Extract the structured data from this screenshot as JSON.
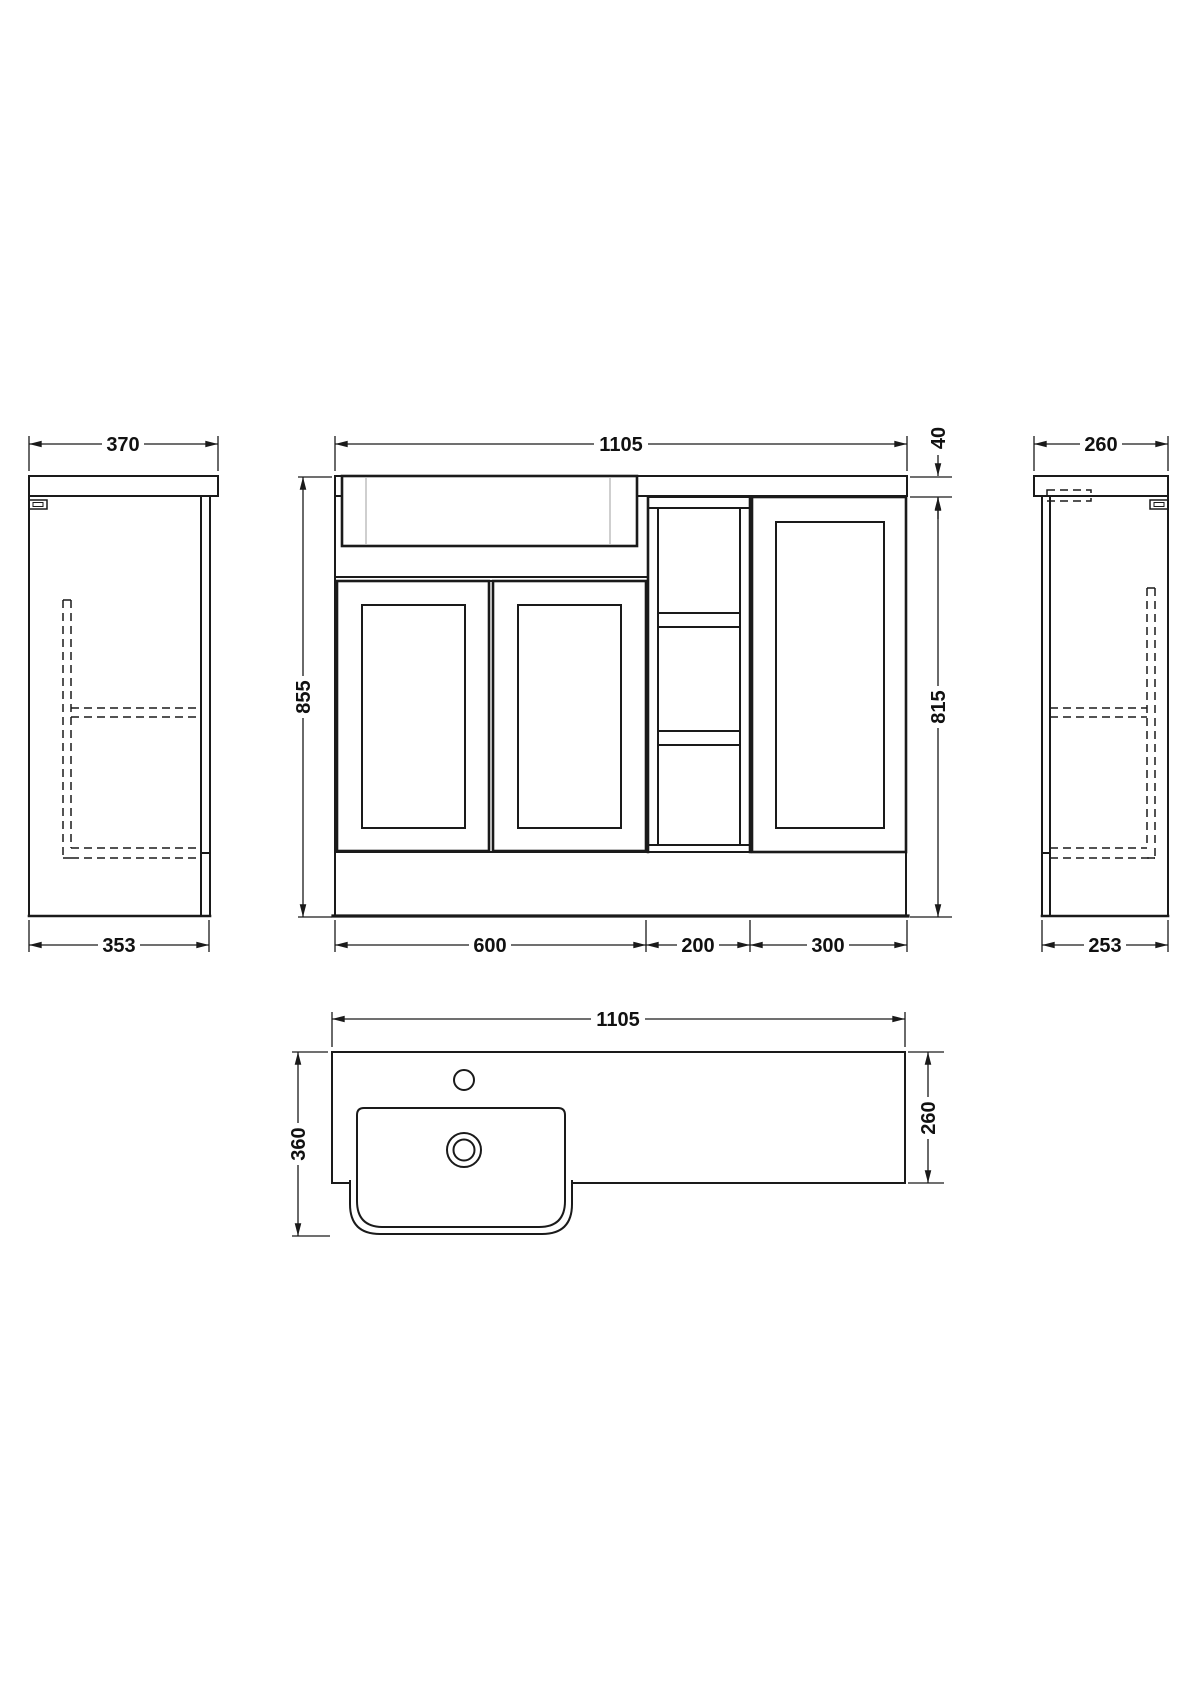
{
  "style": {
    "background": "#ffffff",
    "line_color": "#1a1a1a"
  },
  "views": {
    "side_left": {
      "width_top": "370",
      "width_bottom": "353"
    },
    "front": {
      "width": "1105",
      "height_total": "855",
      "worktop_thickness": "40",
      "cabinet_height": "815",
      "vanity_width": "600",
      "shelf_width": "200",
      "wc_width": "300"
    },
    "side_right": {
      "depth_top": "260",
      "depth_bottom": "253"
    },
    "plan": {
      "width": "1105",
      "depth_total": "360",
      "depth_worktop": "260"
    }
  }
}
